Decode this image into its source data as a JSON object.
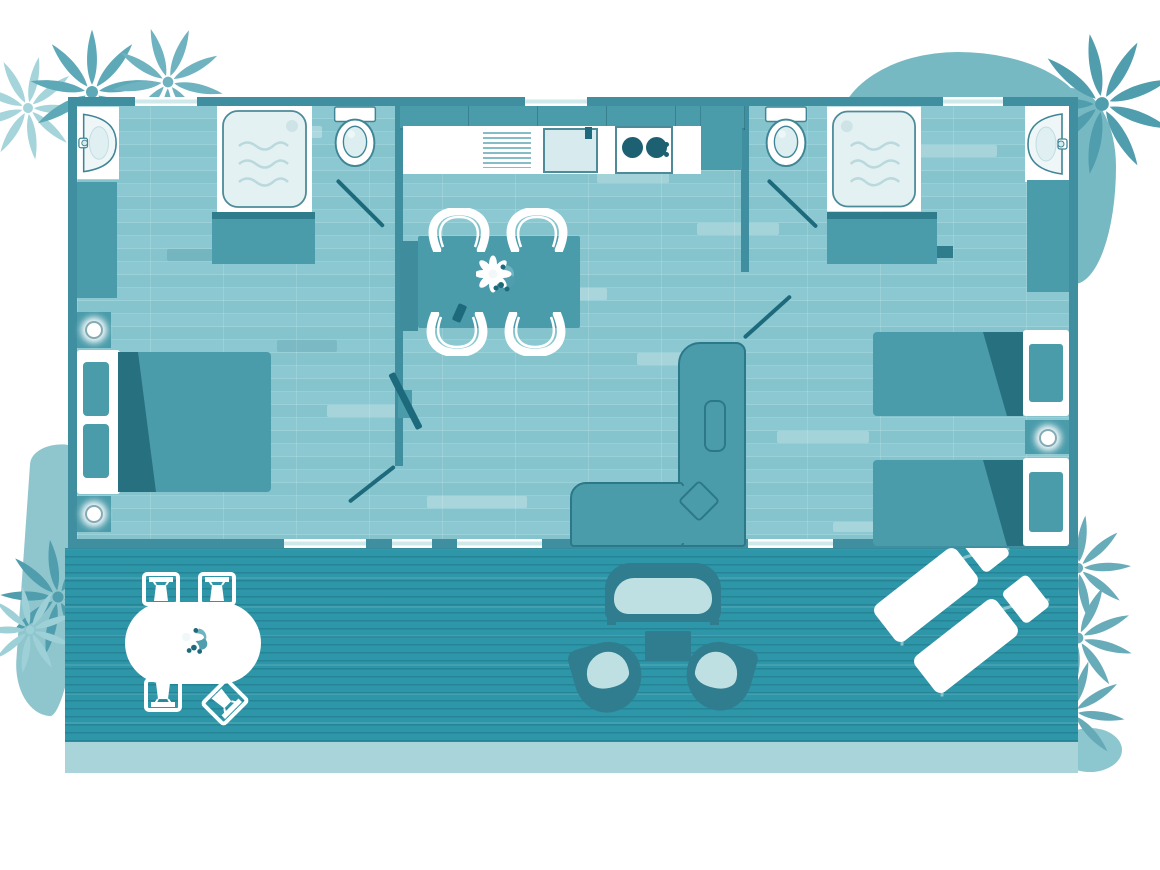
{
  "page": {
    "title_text": "",
    "visible_text": []
  },
  "colors": {
    "page_bg": "#ffffff",
    "wall": "#3f8fa0",
    "furniture": "#4b9cab",
    "furniture_dark": "#2f7d8c",
    "accent_dark": "#1d6a7c",
    "fold": "#26707f",
    "floor_base": "#8ac7d0",
    "deck": "#2d96a8",
    "deck_edge": "#a9d4d9",
    "fixture_fill": "#e4f1f2",
    "fixture_stroke": "#4d8b99",
    "window_line": "#cfe8ea",
    "cushion": "#bfe0e3",
    "patio_frame": "#2f7d8e",
    "blob": "#76b9c2",
    "blob_light": "#8cc6ce",
    "plant_dark": "#4f9dad",
    "plant_medium": "#68abb9",
    "plant_soft": "#8fc6ce",
    "plant_light": "#a5d4da",
    "white": "#ffffff"
  },
  "elements": {
    "interior_furniture": [
      "double-bed",
      "twin-bed",
      "twin-bed",
      "bedside-table",
      "bedside-table",
      "bedside-table",
      "wardrobe",
      "wardrobe",
      "l-shaped-sofa",
      "tv",
      "dining-table",
      "dining-bench",
      "dining-chair",
      "dining-chair",
      "dining-chair",
      "dining-chair",
      "kitchen-upper-cabinets",
      "kitchen-counter",
      "draining-board",
      "kitchen-sink",
      "hob-two-burners",
      "tall-cabinet"
    ],
    "bathroom_fixtures": [
      "washbasin-left",
      "shower-left",
      "toilet-left",
      "toilet-right",
      "shower-right",
      "washbasin-right"
    ],
    "terrace_furniture": [
      "patio-table",
      "patio-chair",
      "patio-chair",
      "patio-chair",
      "patio-chair",
      "outdoor-bench",
      "outdoor-armchair",
      "outdoor-armchair",
      "outdoor-coffee-table",
      "sun-lounger",
      "sun-lounger"
    ],
    "decor": [
      "palm-plant-top-left",
      "palm-plant-top-right",
      "palm-plants-bottom-right",
      "palm-plants-bottom-left",
      "organic-blob-top-right",
      "organic-blob-bottom-left",
      "flower-centerpiece-dining",
      "flower-centerpiece-patio"
    ]
  }
}
